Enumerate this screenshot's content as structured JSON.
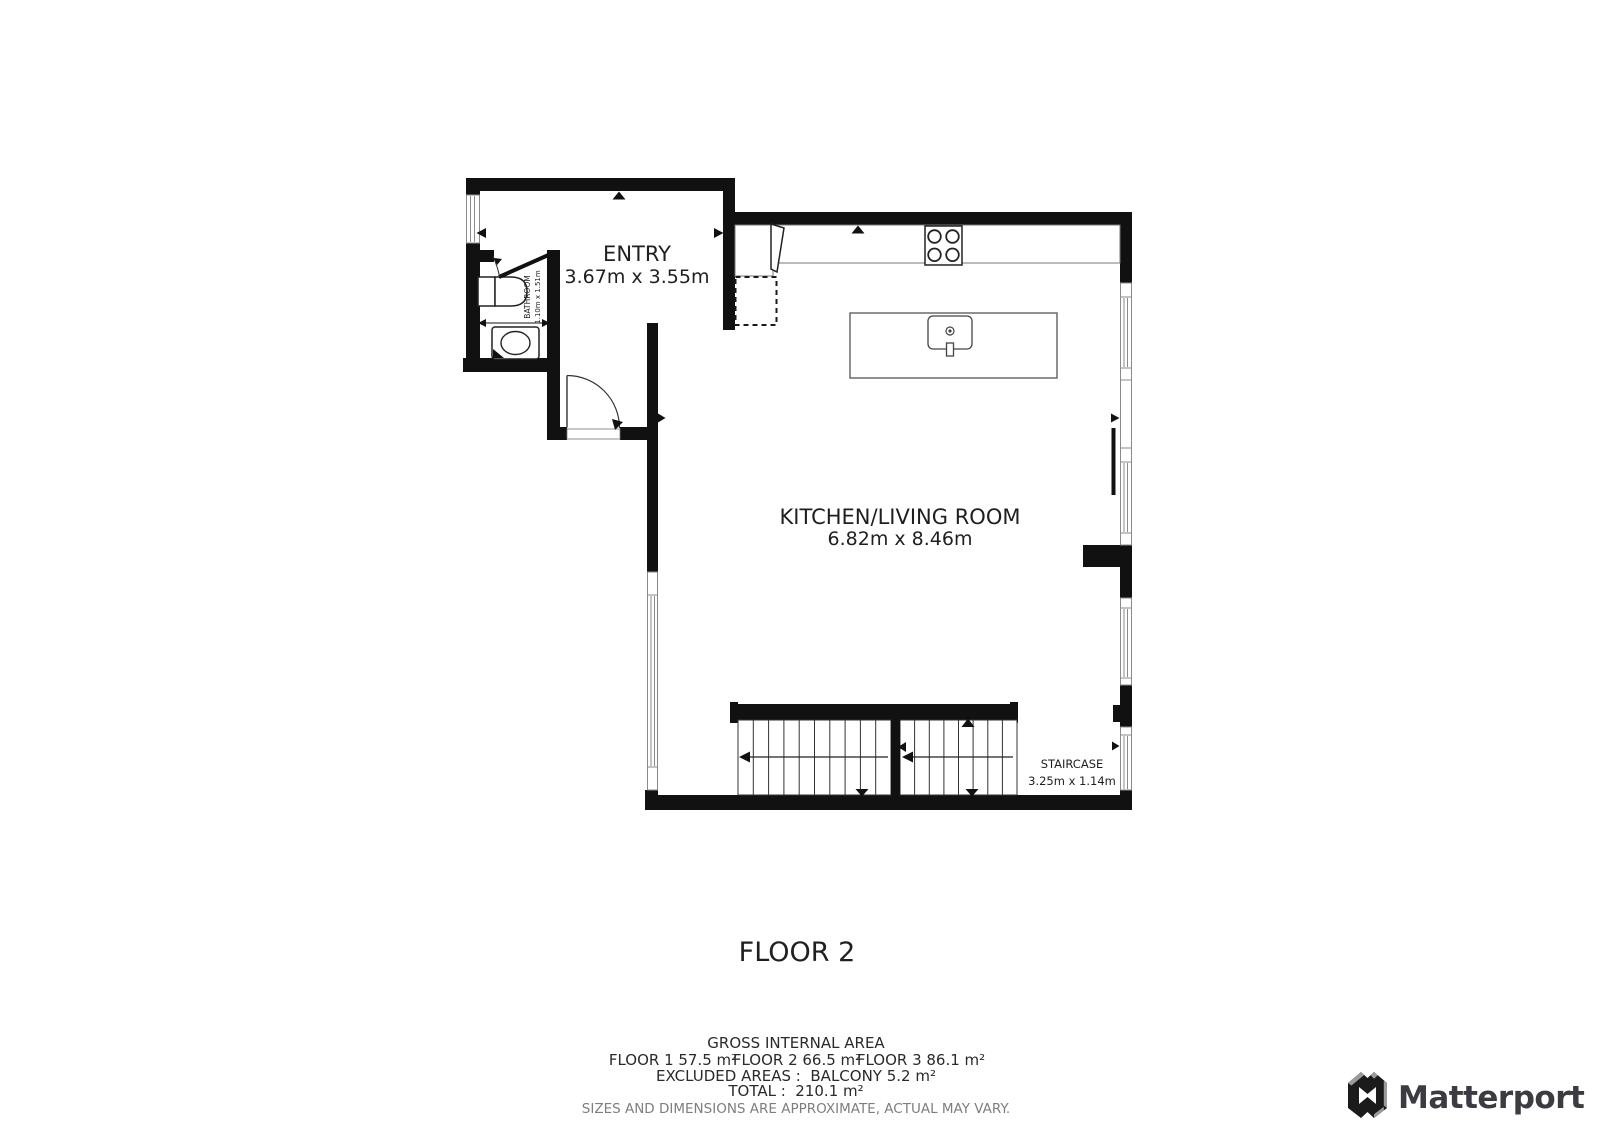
{
  "title": {
    "floor_label": "FLOOR 2"
  },
  "rooms": {
    "entry": {
      "name": "ENTRY",
      "dims": "3.67m x 3.55m"
    },
    "kitchen_living": {
      "name": "KITCHEN/LIVING ROOM",
      "dims": "6.82m x 8.46m"
    },
    "bathroom": {
      "name": "BATHROOM",
      "dims": "1.10m x 1.51m"
    },
    "staircase": {
      "name": "STAIRCASE",
      "dims": "3.25m x 1.14m"
    }
  },
  "footer": {
    "heading": "GROSS INTERNAL AREA",
    "floor_areas": [
      "FLOOR 1 57.5 m²",
      "FLOOR 2 66.5 m²",
      "FLOOR 3 86.1 m²"
    ],
    "excluded": "EXCLUDED AREAS :  BALCONY 5.2 m²",
    "total": "TOTAL :  210.1 m²",
    "disclaimer": "SIZES AND DIMENSIONS ARE APPROXIMATE, ACTUAL MAY VARY."
  },
  "brand": {
    "wordmark": "Matterport"
  },
  "colors": {
    "wall": "#111111",
    "outline": "#3f3f3f",
    "window_frame": "#8a8a8a",
    "text": "#1f1f1f",
    "muted_text": "#7e7e7e",
    "brand_text": "#3b3b41",
    "brand_gray": "#9b9b9b",
    "background": "#ffffff"
  }
}
